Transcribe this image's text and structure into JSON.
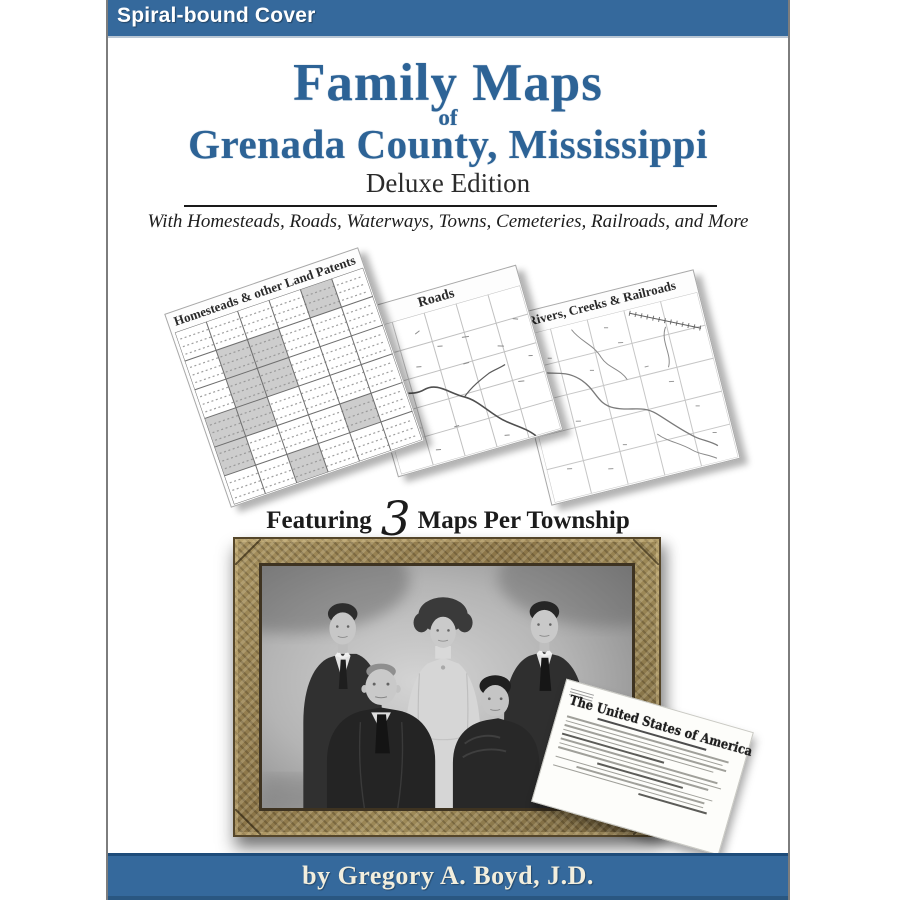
{
  "banner": {
    "label": "Spiral-bound Cover"
  },
  "title": {
    "line1": "Family Maps",
    "of": "of",
    "line2": "Grenada County, Mississippi",
    "edition": "Deluxe Edition",
    "subtitle": "With Homesteads, Roads, Waterways, Towns, Cemeteries, Railroads, and More"
  },
  "maps": {
    "items": [
      {
        "label": "Homesteads & other Land Patents"
      },
      {
        "label": "Roads"
      },
      {
        "label": "Rivers, Creeks & Railroads"
      }
    ],
    "featuring": {
      "prefix": "Featuring",
      "number": "3",
      "suffix": "Maps Per Township"
    }
  },
  "document": {
    "title": "The United States of America"
  },
  "footer": {
    "byline": "by Gregory A. Boyd, J.D."
  },
  "colors": {
    "banner_blue": "#35699c",
    "title_blue": "#2d6396",
    "bar_border_navy": "#1e4c7a",
    "byline_cream": "#f2eedd",
    "frame_wood": "#93804f",
    "rule_dark": "#1a1a1a"
  }
}
